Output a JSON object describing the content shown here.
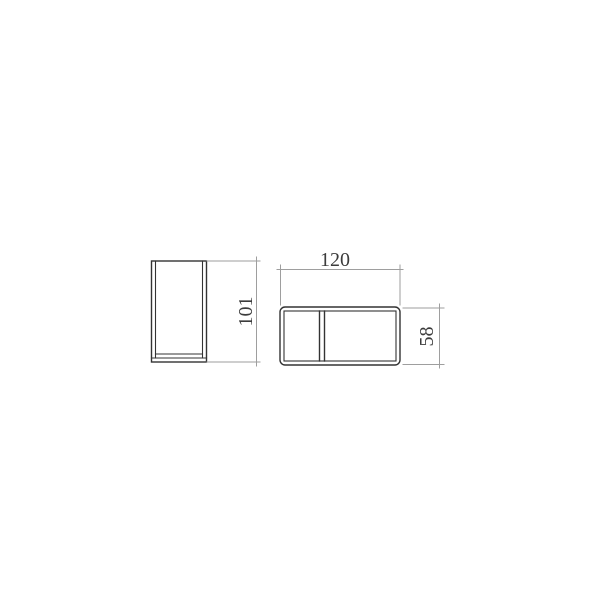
{
  "drawing": {
    "background": "#ffffff",
    "object_line_color": "#333333",
    "dimension_line_color": "#9e9e9e",
    "text_color": "#3c3c3c",
    "labels": {
      "front_width": "120",
      "side_height": "101",
      "front_height": "58"
    }
  }
}
